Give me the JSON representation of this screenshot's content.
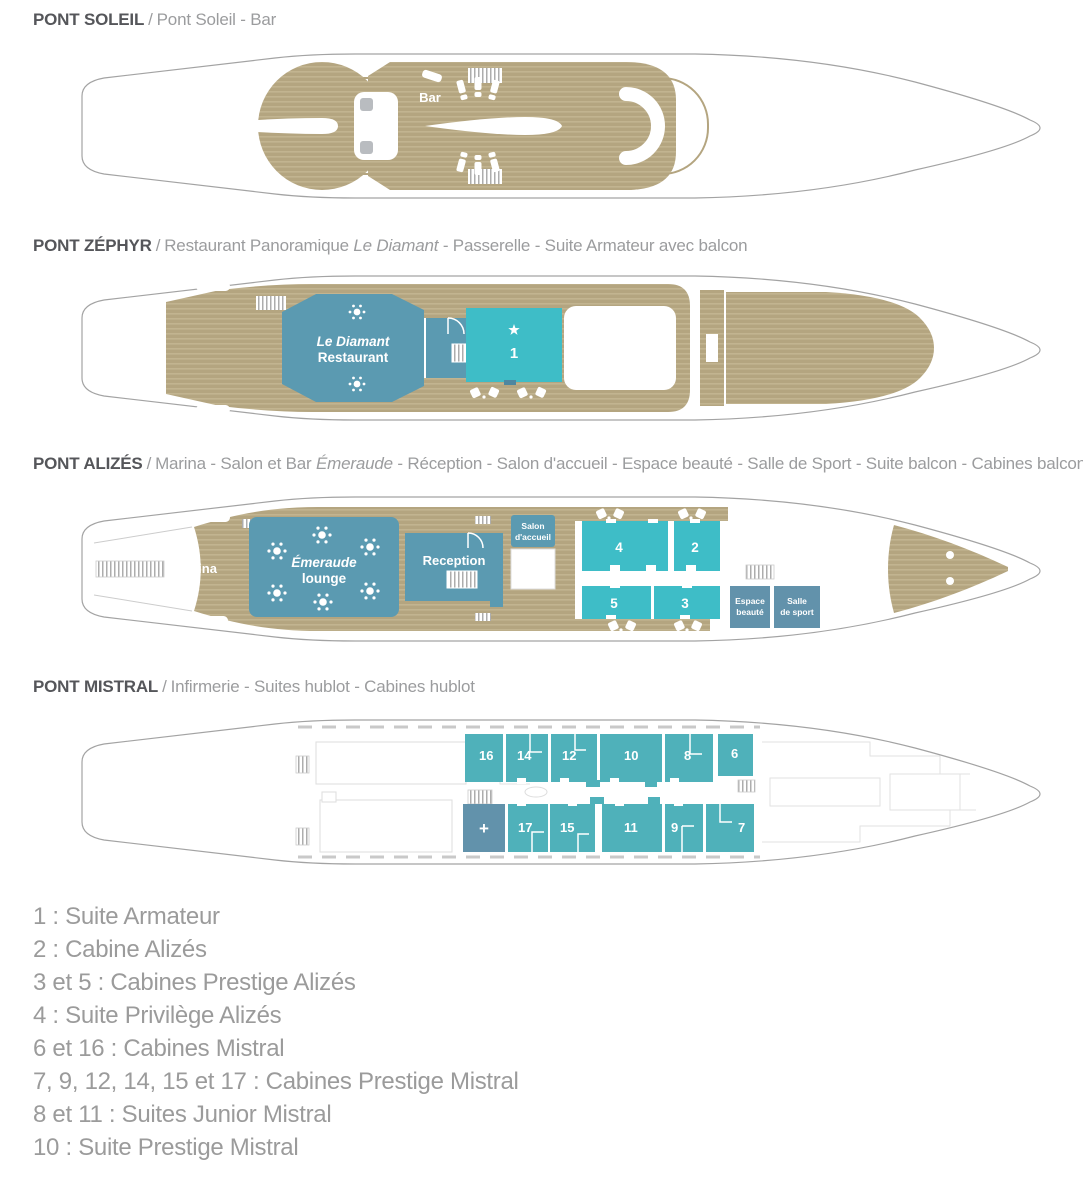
{
  "colors": {
    "tan": "#b4a580",
    "tan_l": "#c2b490",
    "blue": "#5b9ab1",
    "teal": "#3ebdc7",
    "teal2": "#4fb1ba",
    "dkblue": "#6292ab",
    "hull_stroke": "#a3a3a3",
    "title_text": "#55565a",
    "subtitle_text": "#9b9c9e",
    "legend_text": "#9b9b9b"
  },
  "decks": {
    "soleil": {
      "title": "PONT SOLEIL",
      "sep": "/",
      "sub1": "Pont Soleil - Bar",
      "italic": "",
      "sub2": "",
      "labels": {
        "bar": "Bar"
      }
    },
    "zephyr": {
      "title": "PONT ZÉPHYR",
      "sep": "/",
      "sub1": "Restaurant Panoramique ",
      "italic": "Le Diamant",
      "sub2": " - Passerelle - Suite Armateur avec balcon",
      "labels": {
        "restaurant1": "Le Diamant",
        "restaurant2": "Restaurant",
        "suite1": "1"
      }
    },
    "alizes": {
      "title": "PONT ALIZÉS",
      "sep": "/",
      "sub1": "Marina - Salon et Bar ",
      "italic": "Émeraude",
      "sub2": " - Réception - Salon d'accueil - Espace beauté - Salle de Sport - Suite balcon - Cabines balcon",
      "labels": {
        "marina": "Marina",
        "lounge1": "Émeraude",
        "lounge2": "lounge",
        "reception": "Reception",
        "salon1": "Salon",
        "salon2": "d'accueil",
        "espace1": "Espace",
        "espace2": "beauté",
        "salle1": "Salle",
        "salle2": "de sport",
        "cabin4": "4",
        "cabin2": "2",
        "cabin5": "5",
        "cabin3": "3"
      }
    },
    "mistral": {
      "title": "PONT MISTRAL",
      "sep": "/",
      "sub1": "Infirmerie - Suites hublot - Cabines hublot",
      "italic": "",
      "sub2": "",
      "labels": {
        "infirmerie": "+",
        "c16": "16",
        "c14": "14",
        "c12": "12",
        "c10": "10",
        "c8": "8",
        "c6": "6",
        "c17": "17",
        "c15": "15",
        "c11": "11",
        "c9": "9",
        "c7": "7"
      }
    }
  },
  "legend": [
    "1 : Suite Armateur",
    "2 : Cabine Alizés",
    "3 et 5 : Cabines Prestige Alizés",
    "4 : Suite Privilège Alizés",
    "6 et 16 : Cabines Mistral",
    "7, 9, 12, 14, 15 et 17 : Cabines Prestige Mistral",
    "8 et 11 : Suites Junior Mistral",
    "10 : Suite Prestige Mistral"
  ]
}
